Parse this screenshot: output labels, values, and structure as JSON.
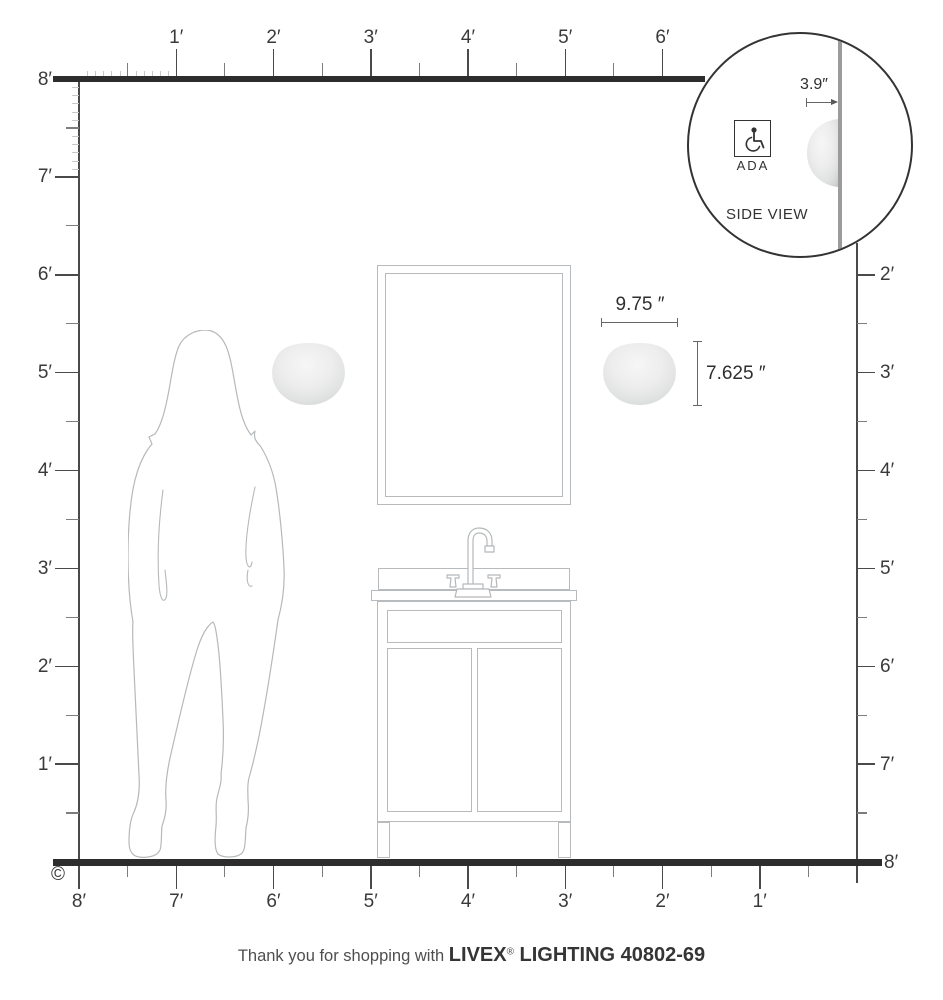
{
  "rulers": {
    "top_labels": [
      "1′",
      "2′",
      "3′",
      "4′",
      "5′",
      "6′"
    ],
    "left_labels": [
      "8′",
      "7′",
      "6′",
      "5′",
      "4′",
      "3′",
      "2′",
      "1′"
    ],
    "right_labels": [
      "2′",
      "3′",
      "4′",
      "5′",
      "6′",
      "7′",
      "8′"
    ],
    "bottom_labels": [
      "8′",
      "7′",
      "6′",
      "5′",
      "4′",
      "3′",
      "2′",
      "1′"
    ]
  },
  "inset": {
    "dimension_label": "3.9″",
    "ada_label": "ADA",
    "caption": "SIDE VIEW"
  },
  "fixture": {
    "width_label": "9.75 ″",
    "height_label": "7.625 ″"
  },
  "footer": {
    "prefix": "Thank you for shopping with ",
    "brand": "LIVEX",
    "registered_mark": "®",
    "suffix": " LIGHTING 40802-69"
  },
  "copyright_symbol": "©",
  "colors": {
    "wall_line": "#2d2d2d",
    "ruler_line": "#4a4a4a",
    "major_tick": "#4a4a4a",
    "half_tick": "#7d7d7d",
    "inch_tick": "#c8c8c8",
    "outline": "#b7bbbd",
    "text": "#3a3a3a"
  }
}
